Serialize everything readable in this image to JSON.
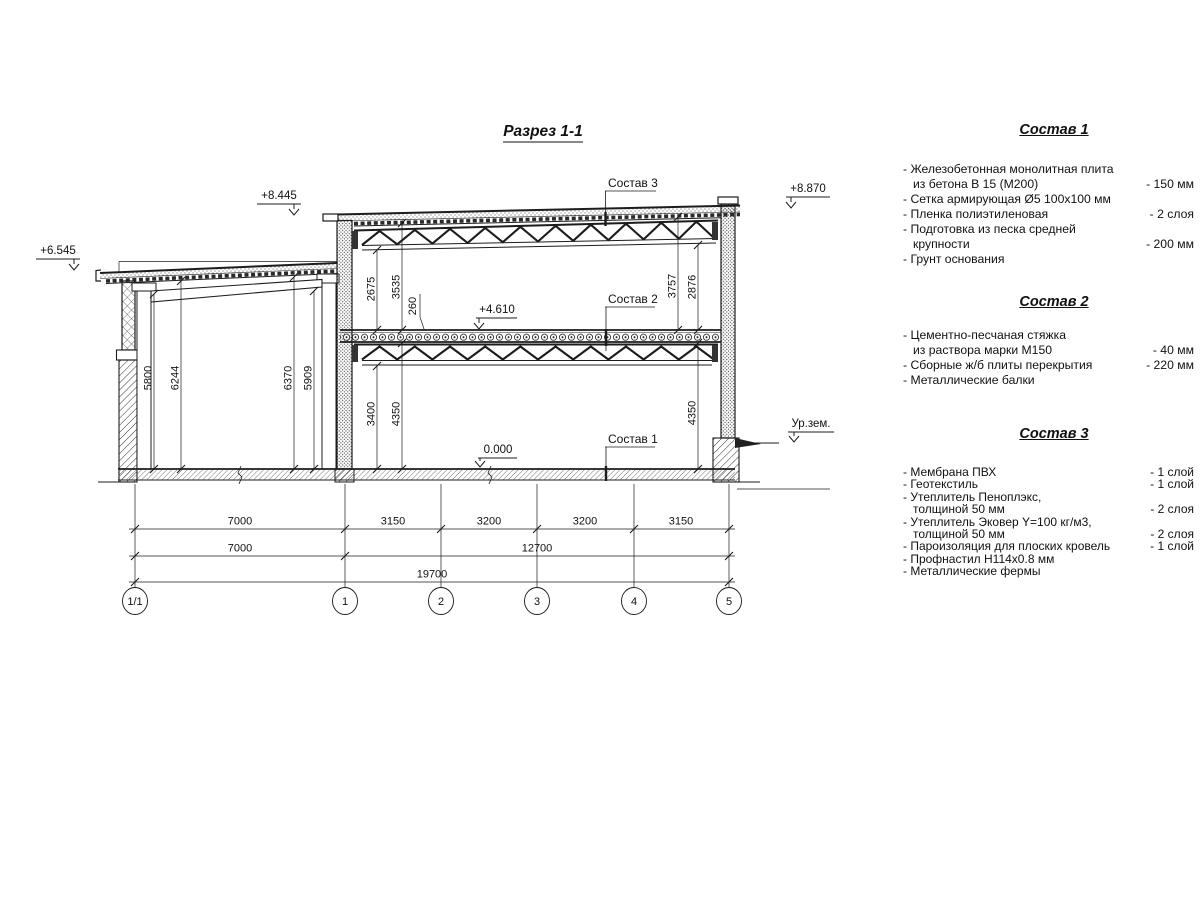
{
  "drawing": {
    "title": "Разрез 1-1",
    "elevations": {
      "left": "+6.545",
      "mid": "+8.445",
      "right": "+8.870",
      "floor2": "+4.610",
      "zero": "0.000",
      "ground": "Ур.зем."
    },
    "callouts": {
      "c1": "Состав 1",
      "c2": "Состав 2",
      "c3": "Состав 3"
    },
    "vdims": {
      "v5800": "5800",
      "v6244": "6244",
      "v6370": "6370",
      "v5909": "5909",
      "v2675": "2675",
      "v3535": "3535",
      "v260": "260",
      "v3400": "3400",
      "v4350a": "4350",
      "v3757": "3757",
      "v2876": "2876",
      "v4350b": "4350"
    },
    "hdims": {
      "row1": [
        "7000",
        "3150",
        "3200",
        "3200",
        "3150"
      ],
      "row2": [
        "7000",
        "12700"
      ],
      "row3": [
        "19700"
      ]
    },
    "axes": [
      "1/1",
      "1",
      "2",
      "3",
      "4",
      "5"
    ]
  },
  "panels": [
    {
      "heading": "Состав 1",
      "rows": [
        {
          "label": "- Железобетонная  монолитная плита",
          "value": ""
        },
        {
          "label": "из бетона В 15 (М200)",
          "value": "- 150 мм"
        },
        {
          "label": "- Сетка армирующая Ø5 100х100 мм",
          "value": ""
        },
        {
          "label": "- Пленка полиэтиленовая",
          "value": "- 2 слоя"
        },
        {
          "label": "- Подготовка из песка средней",
          "value": ""
        },
        {
          "label": "крупности",
          "value": "- 200 мм"
        },
        {
          "label": "- Грунт основания",
          "value": ""
        }
      ]
    },
    {
      "heading": "Состав 2",
      "rows": [
        {
          "label": "- Цементно-песчаная стяжка",
          "value": ""
        },
        {
          "label": "из раствора марки М150",
          "value": "- 40 мм"
        },
        {
          "label": "- Сборные ж/б плиты перекрытия",
          "value": "- 220 мм"
        },
        {
          "label": "- Металлические балки",
          "value": ""
        }
      ]
    },
    {
      "heading": "Состав 3",
      "rows": [
        {
          "label": "- Мембрана ПВХ",
          "value": "- 1 слой"
        },
        {
          "label": "- Геотекстиль",
          "value": "- 1 слой"
        },
        {
          "label": "- Утеплитель Пеноплэкс,",
          "value": ""
        },
        {
          "label": "толщиной 50 мм",
          "value": "- 2 слоя"
        },
        {
          "label": "- Утеплитель Эковер Y=100 кг/м3,",
          "value": ""
        },
        {
          "label": "толщиной 50 мм",
          "value": "- 2 слоя"
        },
        {
          "label": "- Пароизоляция для плоских кровель",
          "value": "- 1 слой"
        },
        {
          "label": "- Профнастил Н114х0.8 мм",
          "value": ""
        },
        {
          "label": "- Металлические фермы",
          "value": ""
        }
      ]
    }
  ]
}
